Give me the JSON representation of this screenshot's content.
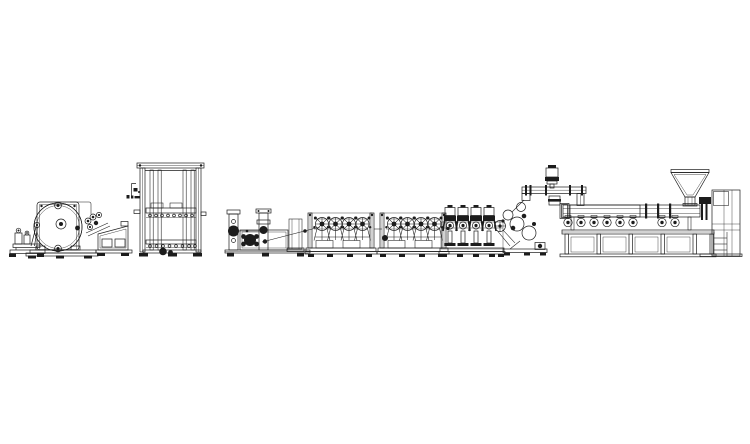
{
  "meta": {
    "title": "Plastic sheet extrusion line - technical side-view CAD drawing",
    "background_color": "#ffffff",
    "line_color": "#1c1c1c",
    "canvas_width": 750,
    "canvas_height": 444
  },
  "components": {
    "uncoiler_stand": {
      "label": "auxiliary stand with guide rollers"
    },
    "winder": {
      "label": "winder with hatched material roll"
    },
    "pull_roll_unit": {
      "label": "pull-roll unit with roller cluster"
    },
    "cooling_frame": {
      "label": "tall vertical cooling / accumulator frame"
    },
    "sensor_bracket": {
      "label": "small sensor bracket symbol"
    },
    "edge_trim_unit": {
      "label": "edge-trim and tension unit"
    },
    "roller_bank_1": {
      "label": "spoked roller bank 1"
    },
    "roller_bank_2": {
      "label": "spoked roller bank 2"
    },
    "motor_bank": {
      "label": "bank of four vertical motors"
    },
    "calender_stack": {
      "label": "calender roll stack with belt drive"
    },
    "screen_changer": {
      "label": "screen changer piping with small motor"
    },
    "extruder": {
      "label": "extruder barrel with cooling fans and support frame"
    },
    "hopper": {
      "label": "feed hopper"
    },
    "gearbox_stand": {
      "label": "gearbox cabinet and ladder stand"
    }
  }
}
